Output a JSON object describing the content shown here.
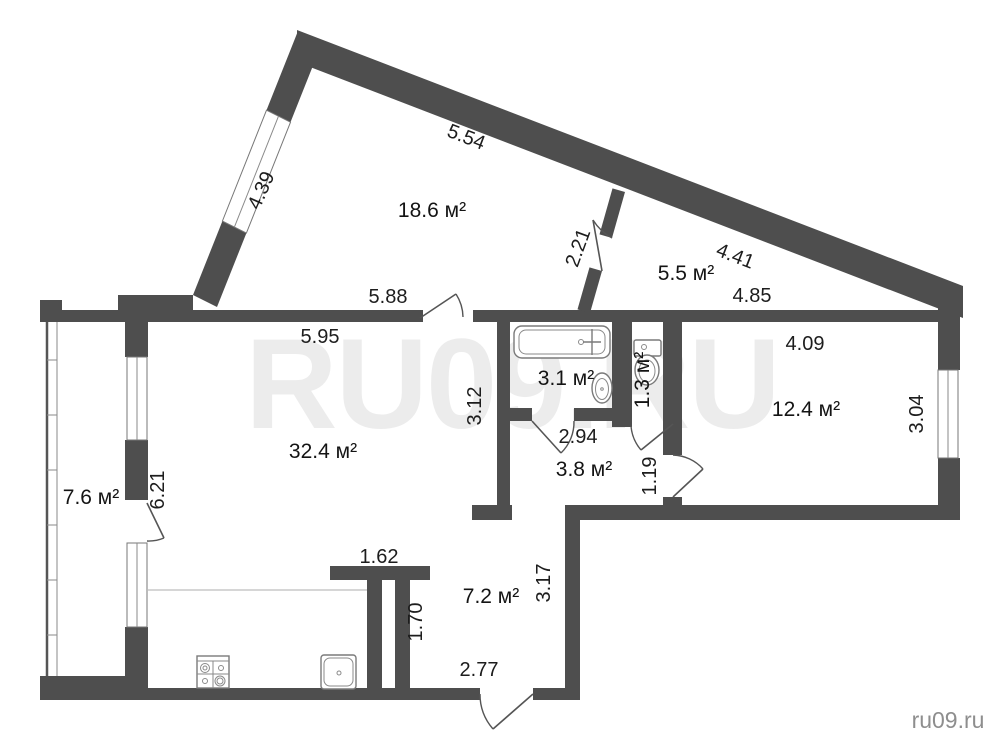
{
  "watermark": {
    "large": "RU09.RU",
    "corner": "ru09.ru"
  },
  "rooms": {
    "living": {
      "label": "18.6 м²"
    },
    "upper": {
      "label": "5.5 м²"
    },
    "bath": {
      "label": "3.1 м²"
    },
    "wc": {
      "label": "1.3 м²"
    },
    "bedroom": {
      "label": "12.4 м²"
    },
    "kitchen": {
      "label": "32.4 м²"
    },
    "balcony": {
      "label": "7.6 м²"
    },
    "hall": {
      "label": "3.8 м²"
    },
    "corridor": {
      "label": "7.2 м²"
    }
  },
  "dimensions": {
    "top_diag_left": "5.54",
    "diag_window": "4.39",
    "inner_diag_wall": "2.21",
    "top_diag_right": "4.41",
    "upper_room_width": "4.85",
    "living_bottom": "5.88",
    "kitchen_top": "5.95",
    "bedroom_width": "4.09",
    "bedroom_height": "3.04",
    "kitchen_right": "3.12",
    "hall_width": "2.94",
    "hall_door_side": "1.19",
    "balcony_side": "6.21",
    "partition_top": "1.62",
    "partition_side": "1.70",
    "corridor_side": "3.17",
    "corridor_bottom": "2.77"
  },
  "colors": {
    "wall": "#4e4e4e",
    "text": "#1d1d1d",
    "fixture_stroke": "#7a7a7a",
    "watermark_corner": "#8e8e8e"
  }
}
